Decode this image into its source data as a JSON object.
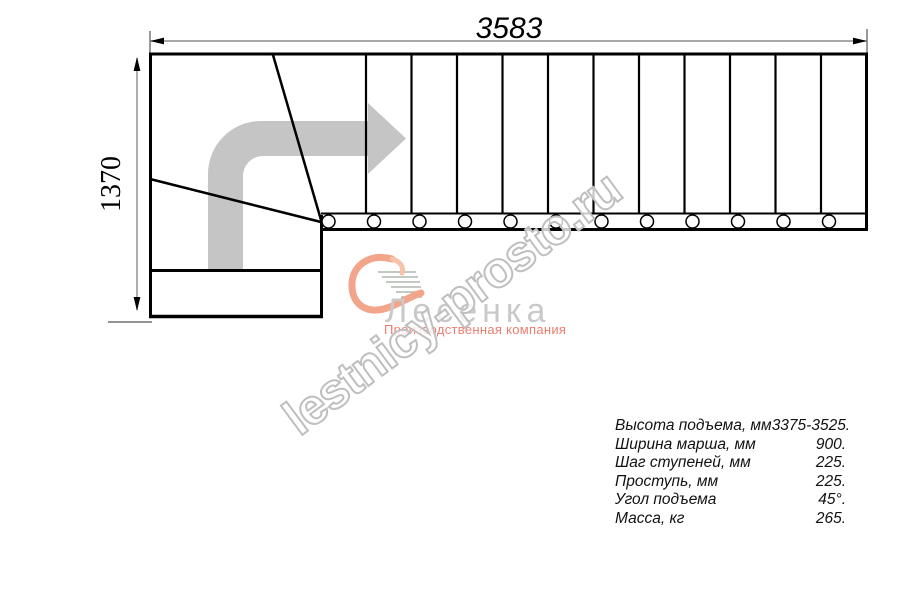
{
  "drawing": {
    "top_dimension": "3583",
    "left_dimension": "1370",
    "steps_count": 12,
    "line_color": "#000000",
    "dim_line_color": "#8c8c8c",
    "arrow_color": "#c5c5c5"
  },
  "watermark": {
    "text": "lestnicy-prosto.ru",
    "stroke_color": "#bfbfbf"
  },
  "logo": {
    "name": "Лесенка",
    "tagline": "Производственная компания",
    "name_color": "#c9c9c9",
    "tagline_color": "#ee7d70",
    "swoosh_color": "#f3a58b"
  },
  "specs": {
    "rows": [
      {
        "label": "Высота подъема, мм",
        "value": "3375-3525."
      },
      {
        "label": "Ширина марша, мм",
        "value": "900."
      },
      {
        "label": "Шаг ступеней, мм",
        "value": "225."
      },
      {
        "label": "Проступь, мм",
        "value": "225."
      },
      {
        "label": "Угол подъема",
        "value": "45°."
      },
      {
        "label": "Масса, кг",
        "value": "265."
      }
    ]
  }
}
